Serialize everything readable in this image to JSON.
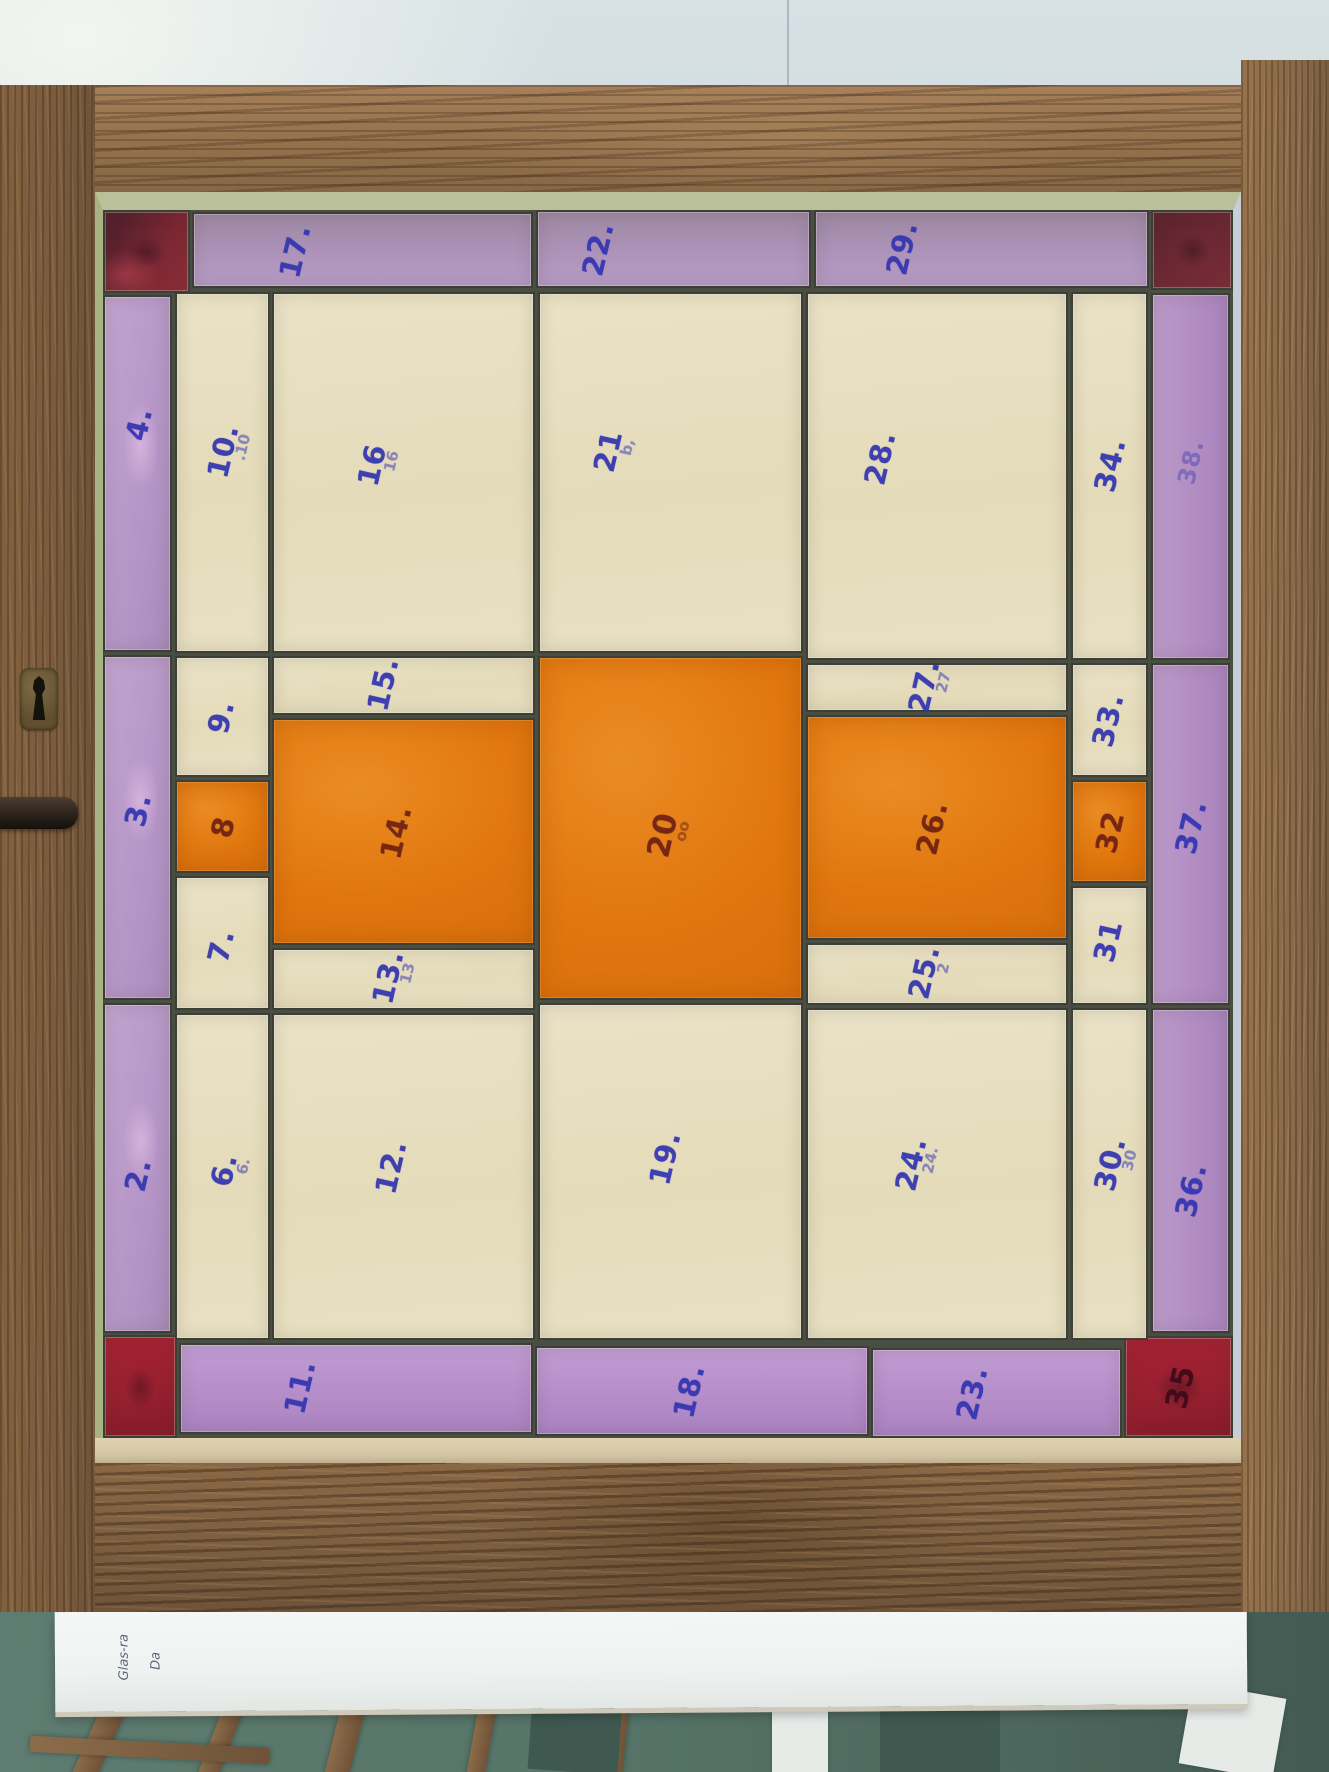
{
  "scene": {
    "subject": "stained-glass window panel in oak frame, panes numbered in blue ink",
    "note_paper": {
      "lines": [
        "Glas-ra",
        "Da"
      ]
    }
  },
  "colors": {
    "wall": "#c9d5dc",
    "oak_frame": "#93714c",
    "cream_glass": "#e7dfc0",
    "purple_glass": "#b495c5",
    "orange_glass": "#e0760e",
    "red_corner_dark": "#6f2934",
    "red_corner_bright": "#a52134",
    "lead_line": "#3c3f35",
    "ink_blue": "#3234b0",
    "ink_maroon": "#691c12",
    "floor_teal": "#577468",
    "paper": "#f4f7f6"
  },
  "window": {
    "panes": [
      {
        "id": "corner-tl",
        "x": 0,
        "y": 0,
        "w": 87,
        "h": 83,
        "color": "red-tl",
        "label": ""
      },
      {
        "id": "17",
        "x": 89,
        "y": 2,
        "w": 341,
        "h": 76,
        "color": "purple-top",
        "label": "17.",
        "lx": 30,
        "ly": 52
      },
      {
        "id": "22",
        "x": 433,
        "y": 0,
        "w": 275,
        "h": 78,
        "color": "purple-top",
        "label": "22.",
        "lx": 22,
        "ly": 50
      },
      {
        "id": "29",
        "x": 711,
        "y": 0,
        "w": 335,
        "h": 78,
        "color": "purple-top",
        "label": "29.",
        "lx": 26,
        "ly": 48
      },
      {
        "id": "corner-tr",
        "x": 1048,
        "y": 0,
        "w": 82,
        "h": 80,
        "color": "red-dark",
        "label": ""
      },
      {
        "id": "4",
        "x": 0,
        "y": 85,
        "w": 69,
        "h": 357,
        "color": "purple-left",
        "label": "4.",
        "lx": 52,
        "ly": 36
      },
      {
        "id": "3",
        "x": 0,
        "y": 445,
        "w": 69,
        "h": 345,
        "color": "purple-left",
        "label": "3.",
        "lx": 50,
        "ly": 45
      },
      {
        "id": "2",
        "x": 0,
        "y": 793,
        "w": 69,
        "h": 330,
        "color": "purple-left",
        "label": "2.",
        "lx": 50,
        "ly": 52
      },
      {
        "id": "corner-bl",
        "x": 0,
        "y": 1125,
        "w": 74,
        "h": 103,
        "color": "red-bright",
        "label": ""
      },
      {
        "id": "11",
        "x": 76,
        "y": 1133,
        "w": 354,
        "h": 91,
        "color": "purple-bottom",
        "label": "11.",
        "lx": 34,
        "ly": 48
      },
      {
        "id": "18",
        "x": 432,
        "y": 1136,
        "w": 334,
        "h": 90,
        "color": "purple-bottom",
        "label": "18.",
        "lx": 46,
        "ly": 50
      },
      {
        "id": "23",
        "x": 768,
        "y": 1138,
        "w": 251,
        "h": 90,
        "color": "purple-bottom",
        "label": "23.",
        "lx": 40,
        "ly": 50
      },
      {
        "id": "35",
        "x": 1021,
        "y": 1126,
        "w": 109,
        "h": 102,
        "color": "red-bright",
        "label": "35",
        "ink": "darkred",
        "lx": 52,
        "ly": 50,
        "size": 30
      },
      {
        "id": "38",
        "x": 1048,
        "y": 83,
        "w": 79,
        "h": 367,
        "color": "purple-right",
        "label": "38.",
        "ink": "faintblue",
        "lx": 50,
        "ly": 46,
        "size": 24
      },
      {
        "id": "37",
        "x": 1048,
        "y": 453,
        "w": 79,
        "h": 342,
        "color": "purple-right",
        "label": "37.",
        "lx": 50,
        "ly": 48
      },
      {
        "id": "36",
        "x": 1048,
        "y": 798,
        "w": 79,
        "h": 325,
        "color": "purple-right",
        "label": "36.",
        "lx": 50,
        "ly": 56
      },
      {
        "id": "10",
        "x": 72,
        "y": 82,
        "w": 95,
        "h": 361,
        "color": "cream",
        "label": "10.",
        "ghost": ".10",
        "lx": 50,
        "ly": 44
      },
      {
        "id": "9",
        "x": 72,
        "y": 446,
        "w": 95,
        "h": 121,
        "color": "cream",
        "label": "9.",
        "lx": 48,
        "ly": 50
      },
      {
        "id": "8",
        "x": 72,
        "y": 570,
        "w": 95,
        "h": 93,
        "color": "orange",
        "label": "8",
        "ink": "maroon",
        "lx": 50,
        "ly": 50
      },
      {
        "id": "7",
        "x": 72,
        "y": 666,
        "w": 95,
        "h": 134,
        "color": "cream",
        "label": "7.",
        "lx": 48,
        "ly": 52
      },
      {
        "id": "6",
        "x": 72,
        "y": 803,
        "w": 95,
        "h": 327,
        "color": "cream",
        "label": "6.",
        "ghost": "6.",
        "lx": 52,
        "ly": 48
      },
      {
        "id": "16",
        "x": 169,
        "y": 82,
        "w": 263,
        "h": 361,
        "color": "cream",
        "label": "16",
        "ghost": "16",
        "lx": 38,
        "ly": 48
      },
      {
        "id": "15",
        "x": 169,
        "y": 446,
        "w": 263,
        "h": 59,
        "color": "cream",
        "label": "15.",
        "lx": 42,
        "ly": 48
      },
      {
        "id": "14",
        "x": 169,
        "y": 508,
        "w": 263,
        "h": 227,
        "color": "orange",
        "label": "14.",
        "ink": "maroon",
        "lx": 47,
        "ly": 50
      },
      {
        "id": "13",
        "x": 169,
        "y": 738,
        "w": 263,
        "h": 62,
        "color": "cream",
        "label": "13.",
        "ghost": "13",
        "lx": 44,
        "ly": 46
      },
      {
        "id": "12",
        "x": 169,
        "y": 803,
        "w": 263,
        "h": 327,
        "color": "cream",
        "label": "12.",
        "lx": 45,
        "ly": 47
      },
      {
        "id": "21",
        "x": 435,
        "y": 82,
        "w": 265,
        "h": 361,
        "color": "cream",
        "label": "21",
        "ghost": "b,",
        "lx": 26,
        "ly": 44
      },
      {
        "id": "20",
        "x": 435,
        "y": 446,
        "w": 265,
        "h": 344,
        "color": "orange",
        "label": "20",
        "ghost": "oo",
        "ink": "maroon",
        "lx": 47,
        "ly": 52,
        "size": 31
      },
      {
        "id": "19",
        "x": 435,
        "y": 793,
        "w": 265,
        "h": 337,
        "color": "cream",
        "label": "19.",
        "lx": 48,
        "ly": 46
      },
      {
        "id": "28",
        "x": 703,
        "y": 82,
        "w": 262,
        "h": 368,
        "color": "cream",
        "label": "28.",
        "lx": 28,
        "ly": 45
      },
      {
        "id": "27",
        "x": 703,
        "y": 453,
        "w": 262,
        "h": 49,
        "color": "cream",
        "label": "27.",
        "ghost": "27",
        "lx": 45,
        "ly": 46
      },
      {
        "id": "26",
        "x": 703,
        "y": 505,
        "w": 262,
        "h": 225,
        "color": "orange",
        "label": "26.",
        "ink": "maroon",
        "lx": 48,
        "ly": 50
      },
      {
        "id": "25",
        "x": 703,
        "y": 733,
        "w": 262,
        "h": 62,
        "color": "cream",
        "label": "25.",
        "ghost": "2",
        "lx": 45,
        "ly": 46
      },
      {
        "id": "24",
        "x": 703,
        "y": 798,
        "w": 262,
        "h": 332,
        "color": "cream",
        "label": "24.",
        "ghost": "24.",
        "lx": 40,
        "ly": 47
      },
      {
        "id": "34",
        "x": 968,
        "y": 82,
        "w": 77,
        "h": 368,
        "color": "cream",
        "label": "34.",
        "lx": 50,
        "ly": 47
      },
      {
        "id": "33",
        "x": 968,
        "y": 453,
        "w": 77,
        "h": 114,
        "color": "cream",
        "label": "33.",
        "lx": 48,
        "ly": 50
      },
      {
        "id": "32",
        "x": 968,
        "y": 570,
        "w": 77,
        "h": 103,
        "color": "orange",
        "label": "32",
        "ink": "maroon",
        "lx": 50,
        "ly": 50
      },
      {
        "id": "31",
        "x": 968,
        "y": 676,
        "w": 77,
        "h": 119,
        "color": "cream",
        "label": "31",
        "lx": 48,
        "ly": 46
      },
      {
        "id": "30",
        "x": 968,
        "y": 798,
        "w": 77,
        "h": 332,
        "color": "cream",
        "label": "30.",
        "ghost": "30",
        "lx": 50,
        "ly": 47
      }
    ]
  }
}
